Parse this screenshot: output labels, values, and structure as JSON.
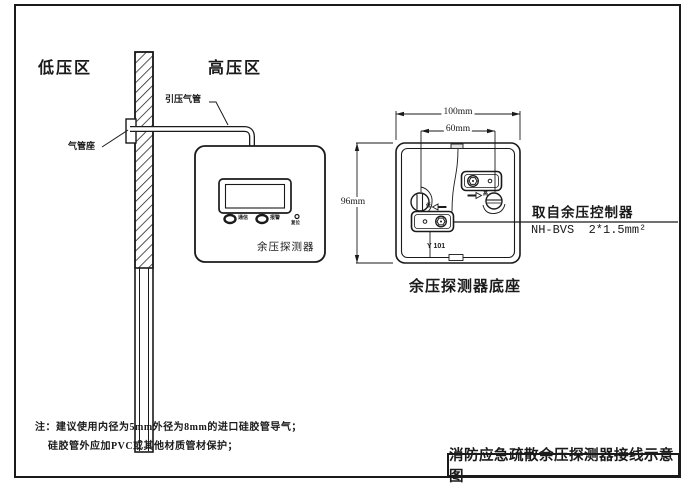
{
  "zones": {
    "low_pressure": "低压区",
    "high_pressure": "高压区"
  },
  "pipe": {
    "pressure_tube_label": "引压气管",
    "tube_seat_label": "气管座"
  },
  "detector": {
    "indicator_comm": "通信",
    "indicator_alarm": "报警",
    "reset_label": "复位",
    "name": "余压探测器"
  },
  "base": {
    "caption": "余压探测器底座",
    "model": "Y 101",
    "dim_width": "100mm",
    "dim_holes": "60mm",
    "dim_height": "96mm",
    "terminal_high": "高",
    "terminal_low": "低",
    "wire_source_line1": "取自余压控制器",
    "wire_source_line2": "NH-BVS  2*1.5mm²"
  },
  "notes": {
    "line1": "注：建议使用内径为5mm外径为8mm的进口硅胶管导气；",
    "line2": "硅胶管外应加PVC或其他材质管材保护；"
  },
  "title_block": {
    "title": "消防应急疏散余压探测器接线示意图"
  },
  "colors": {
    "ink": "#1a1a1a",
    "paper": "#ffffff"
  }
}
